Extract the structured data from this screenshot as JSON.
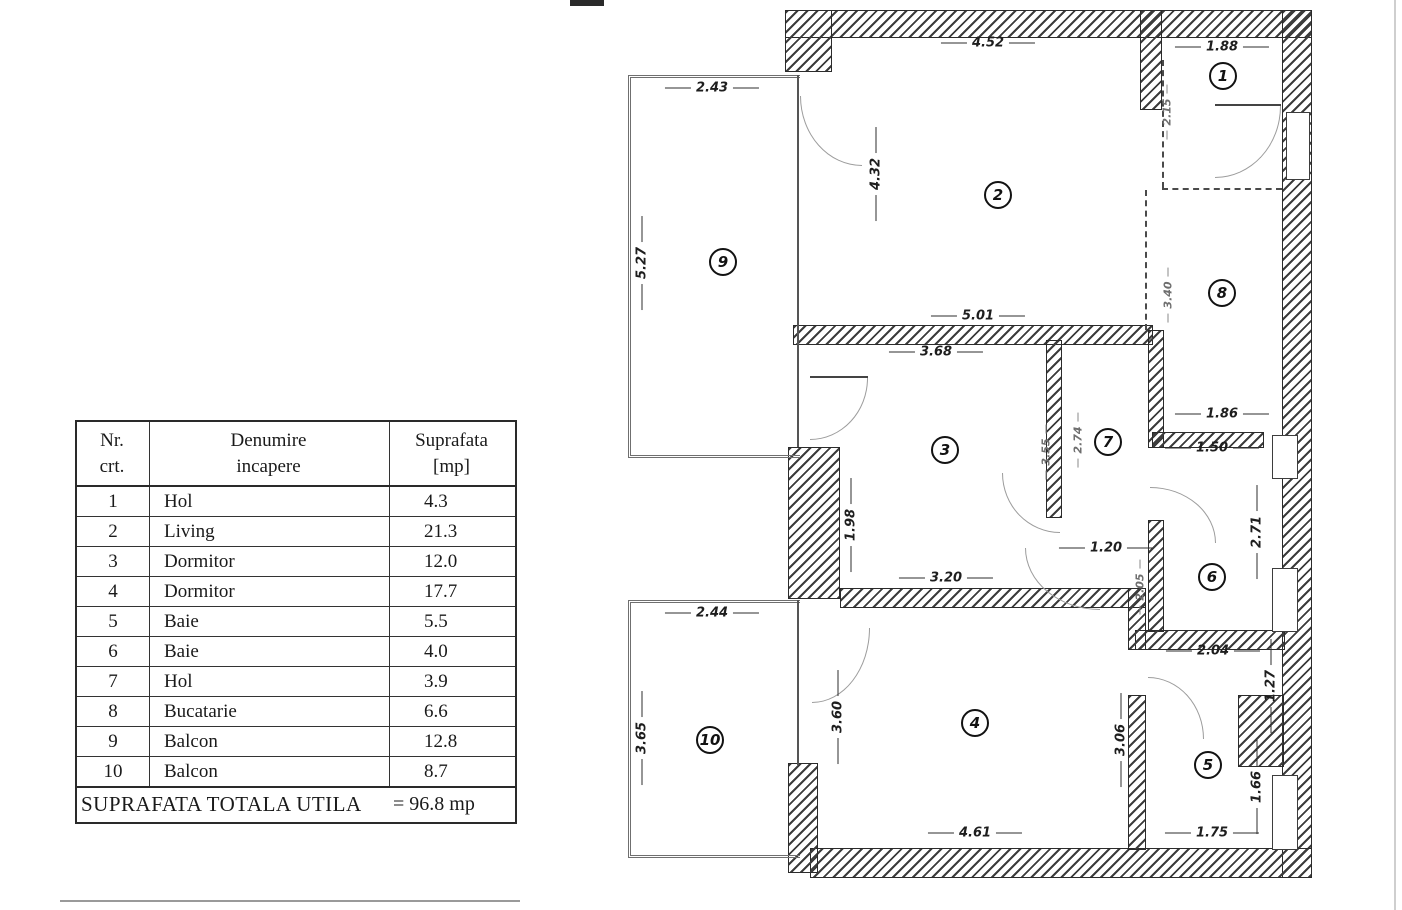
{
  "table": {
    "headers": {
      "col1": "Nr.\ncrt.",
      "col2": "Denumire\nincapere",
      "col3": "Suprafata\n[mp]"
    },
    "rows": [
      {
        "nr": "1",
        "name": "Hol",
        "area": "4.3"
      },
      {
        "nr": "2",
        "name": "Living",
        "area": "21.3"
      },
      {
        "nr": "3",
        "name": "Dormitor",
        "area": "12.0"
      },
      {
        "nr": "4",
        "name": "Dormitor",
        "area": "17.7"
      },
      {
        "nr": "5",
        "name": "Baie",
        "area": "5.5"
      },
      {
        "nr": "6",
        "name": "Baie",
        "area": "4.0"
      },
      {
        "nr": "7",
        "name": "Hol",
        "area": "3.9"
      },
      {
        "nr": "8",
        "name": "Bucatarie",
        "area": "6.6"
      },
      {
        "nr": "9",
        "name": "Balcon",
        "area": "12.8"
      },
      {
        "nr": "10",
        "name": "Balcon",
        "area": "8.7"
      }
    ],
    "footer": {
      "label": "SUPRAFATA TOTALA  UTILA",
      "value": "= 96.8 mp"
    }
  },
  "plan": {
    "rooms": [
      {
        "num": "1",
        "x": 1223,
        "y": 76
      },
      {
        "num": "2",
        "x": 998,
        "y": 195
      },
      {
        "num": "3",
        "x": 945,
        "y": 450
      },
      {
        "num": "4",
        "x": 975,
        "y": 723
      },
      {
        "num": "5",
        "x": 1208,
        "y": 765
      },
      {
        "num": "6",
        "x": 1212,
        "y": 577
      },
      {
        "num": "7",
        "x": 1108,
        "y": 442
      },
      {
        "num": "8",
        "x": 1222,
        "y": 293
      },
      {
        "num": "9",
        "x": 723,
        "y": 262
      },
      {
        "num": "10",
        "x": 710,
        "y": 740
      }
    ],
    "dims": [
      {
        "text": "4.52",
        "x": 988,
        "y": 43,
        "o": "h"
      },
      {
        "text": "1.88",
        "x": 1222,
        "y": 47,
        "o": "h"
      },
      {
        "text": "2.43",
        "x": 712,
        "y": 88,
        "o": "h"
      },
      {
        "text": "2.15",
        "x": 1167,
        "y": 112,
        "o": "v",
        "f": true
      },
      {
        "text": "4.32",
        "x": 876,
        "y": 174,
        "o": "v"
      },
      {
        "text": "5.27",
        "x": 642,
        "y": 263,
        "o": "v"
      },
      {
        "text": "5.01",
        "x": 978,
        "y": 316,
        "o": "h"
      },
      {
        "text": "3.68",
        "x": 936,
        "y": 352,
        "o": "h"
      },
      {
        "text": "3.40",
        "x": 1168,
        "y": 295,
        "o": "v",
        "f": true
      },
      {
        "text": "1.86",
        "x": 1222,
        "y": 414,
        "o": "h"
      },
      {
        "text": "1.50",
        "x": 1212,
        "y": 448,
        "o": "h"
      },
      {
        "text": "3.55",
        "x": 1046,
        "y": 452,
        "o": "v",
        "f": true
      },
      {
        "text": "2.74",
        "x": 1078,
        "y": 440,
        "o": "v",
        "f": true
      },
      {
        "text": "1.98",
        "x": 851,
        "y": 525,
        "o": "v"
      },
      {
        "text": "1.20",
        "x": 1106,
        "y": 548,
        "o": "h"
      },
      {
        "text": "3.20",
        "x": 946,
        "y": 578,
        "o": "h"
      },
      {
        "text": "2.05",
        "x": 1140,
        "y": 587,
        "o": "v",
        "f": true
      },
      {
        "text": "2.71",
        "x": 1257,
        "y": 532,
        "o": "v"
      },
      {
        "text": "2.44",
        "x": 712,
        "y": 613,
        "o": "h"
      },
      {
        "text": "3.65",
        "x": 642,
        "y": 738,
        "o": "v"
      },
      {
        "text": "3.60",
        "x": 838,
        "y": 717,
        "o": "v"
      },
      {
        "text": "3.06",
        "x": 1121,
        "y": 740,
        "o": "v"
      },
      {
        "text": "2.04",
        "x": 1213,
        "y": 651,
        "o": "h"
      },
      {
        "text": "1.27",
        "x": 1271,
        "y": 686,
        "o": "v"
      },
      {
        "text": "1.66",
        "x": 1257,
        "y": 787,
        "o": "v"
      },
      {
        "text": "1.75",
        "x": 1212,
        "y": 833,
        "o": "h"
      },
      {
        "text": "4.61",
        "x": 975,
        "y": 833,
        "o": "h"
      }
    ],
    "walls": [
      {
        "x": 785,
        "y": 10,
        "w": 527,
        "h": 28
      },
      {
        "x": 785,
        "y": 10,
        "w": 47,
        "h": 62
      },
      {
        "x": 1282,
        "y": 10,
        "w": 30,
        "h": 868
      },
      {
        "x": 810,
        "y": 848,
        "w": 502,
        "h": 30
      },
      {
        "x": 793,
        "y": 325,
        "w": 360,
        "h": 20
      },
      {
        "x": 788,
        "y": 447,
        "w": 52,
        "h": 152
      },
      {
        "x": 840,
        "y": 588,
        "w": 306,
        "h": 20
      },
      {
        "x": 1046,
        "y": 340,
        "w": 16,
        "h": 178
      },
      {
        "x": 1148,
        "y": 330,
        "w": 16,
        "h": 118
      },
      {
        "x": 1152,
        "y": 432,
        "w": 112,
        "h": 16
      },
      {
        "x": 1148,
        "y": 520,
        "w": 16,
        "h": 112
      },
      {
        "x": 1135,
        "y": 630,
        "w": 150,
        "h": 20
      },
      {
        "x": 1128,
        "y": 588,
        "w": 18,
        "h": 62
      },
      {
        "x": 1128,
        "y": 695,
        "w": 18,
        "h": 155
      },
      {
        "x": 1238,
        "y": 695,
        "w": 46,
        "h": 72
      },
      {
        "x": 1140,
        "y": 10,
        "w": 22,
        "h": 100
      },
      {
        "x": 788,
        "y": 763,
        "w": 30,
        "h": 110
      }
    ],
    "balconies": [
      {
        "x": 628,
        "y": 75,
        "w": 172,
        "h": 383
      },
      {
        "x": 628,
        "y": 600,
        "w": 172,
        "h": 258
      }
    ],
    "windows": [
      {
        "x": 1286,
        "y": 112,
        "w": 24,
        "h": 68
      },
      {
        "x": 1272,
        "y": 435,
        "w": 26,
        "h": 44
      },
      {
        "x": 1272,
        "y": 568,
        "w": 26,
        "h": 64
      },
      {
        "x": 1272,
        "y": 775,
        "w": 26,
        "h": 75
      }
    ],
    "dashes": [
      {
        "x": 1145,
        "y": 190,
        "w": 2,
        "h": 140
      },
      {
        "x": 1162,
        "y": 188,
        "w": 120,
        "h": 2
      },
      {
        "x": 1162,
        "y": 60,
        "w": 2,
        "h": 128
      }
    ],
    "lines": [
      {
        "x": 797,
        "y": 75,
        "w": 2,
        "h": 372,
        "c": "#555"
      },
      {
        "x": 797,
        "y": 600,
        "w": 2,
        "h": 165,
        "c": "#555"
      },
      {
        "x": 1215,
        "y": 104,
        "w": 66,
        "h": 2,
        "c": "#444"
      },
      {
        "x": 810,
        "y": 376,
        "w": 58,
        "h": 2,
        "c": "#444"
      },
      {
        "x": 60,
        "y": 900,
        "w": 460,
        "h": 2,
        "c": "#9a9a9a"
      },
      {
        "x": 1394,
        "y": 0,
        "w": 2,
        "h": 910,
        "c": "#cfcfcf"
      },
      {
        "x": 570,
        "y": 0,
        "w": 34,
        "h": 6,
        "c": "#2a2a2a"
      }
    ],
    "doors": [
      {
        "x": 800,
        "y": 96,
        "w": 62,
        "h": 70,
        "q": "bl"
      },
      {
        "x": 1215,
        "y": 106,
        "w": 66,
        "h": 72,
        "q": "br"
      },
      {
        "x": 810,
        "y": 378,
        "w": 58,
        "h": 62,
        "q": "br"
      },
      {
        "x": 1002,
        "y": 473,
        "w": 58,
        "h": 60,
        "q": "bl"
      },
      {
        "x": 1150,
        "y": 487,
        "w": 66,
        "h": 56,
        "q": "tr"
      },
      {
        "x": 812,
        "y": 628,
        "w": 58,
        "h": 75,
        "q": "br"
      },
      {
        "x": 1148,
        "y": 677,
        "w": 56,
        "h": 62,
        "q": "tr"
      },
      {
        "x": 1025,
        "y": 548,
        "w": 75,
        "h": 62,
        "q": "bl"
      }
    ]
  },
  "colors": {
    "ink": "#1a1a1a",
    "hatch": "#3c3c3c",
    "door": "#9c9c9c"
  }
}
